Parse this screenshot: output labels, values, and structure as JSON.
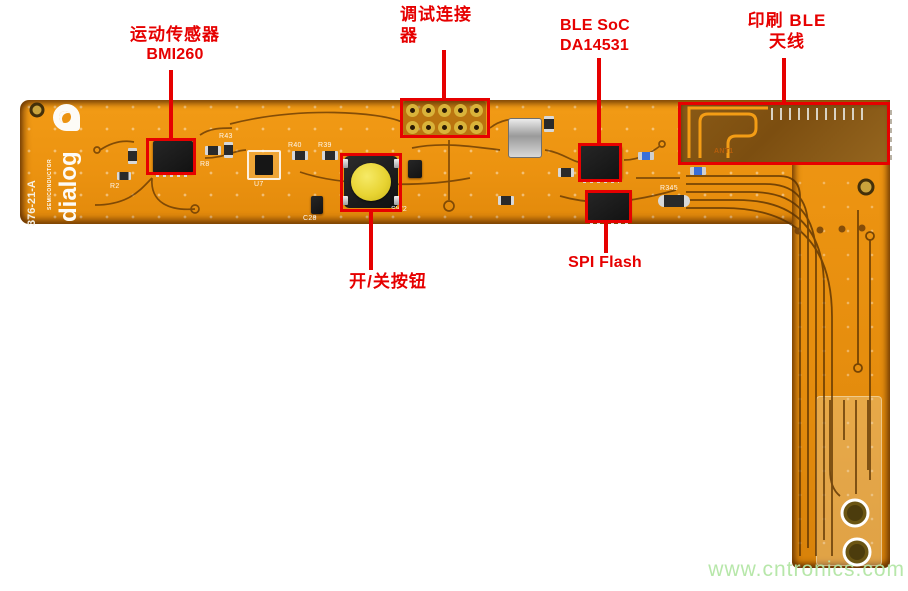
{
  "annotations": {
    "motion_sensor": {
      "line1": "运动传感器",
      "line2": "BMI260"
    },
    "debug_connector": {
      "line1": "调试连接",
      "line2": "器"
    },
    "ble_soc": {
      "line1": "BLE SoC",
      "line2": "DA14531"
    },
    "printed_antenna": {
      "line1": "印刷 BLE",
      "line2": "天线"
    },
    "spi_flash": {
      "label": "SPI Flash"
    },
    "power_button": {
      "label": "开/关按钮"
    }
  },
  "board": {
    "logo": {
      "brand": "dialog",
      "sub": "SEMICONDUCTOR"
    },
    "board_id": "376-21-A",
    "silkscreen": {
      "r2": "R2",
      "r8": "R8",
      "r40": "R40",
      "r39": "R39",
      "r43": "R43",
      "c28": "C28",
      "r345": "R345",
      "sw2": "SW2",
      "u7": "U7",
      "ant1": "ANT1"
    }
  },
  "watermark": "www.cntronics.com",
  "colors": {
    "annotation_red": "#e60000",
    "board_orange": "#ef9712",
    "antenna_brown": "#7c4e10",
    "watermark_green": "#b4e6a6"
  }
}
